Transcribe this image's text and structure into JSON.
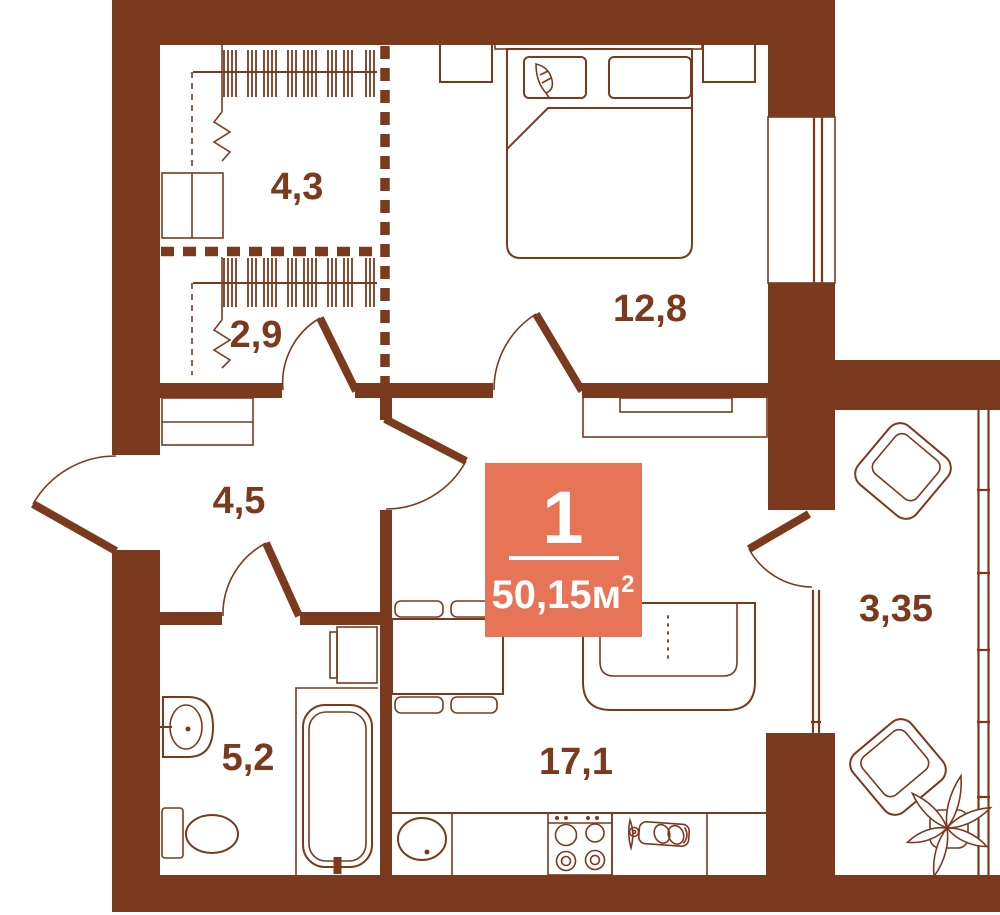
{
  "plan": {
    "kind": "apartment-floor-plan",
    "badge": {
      "room_count": "1",
      "area_value": "50,15м",
      "area_superscript": "2"
    },
    "rooms": [
      {
        "name": "wardrobe-upper",
        "area_label": "4,3"
      },
      {
        "name": "wardrobe-lower",
        "area_label": "2,9"
      },
      {
        "name": "hallway",
        "area_label": "4,5"
      },
      {
        "name": "bedroom",
        "area_label": "12,8"
      },
      {
        "name": "balcony",
        "area_label": "3,35"
      },
      {
        "name": "bathroom",
        "area_label": "5,2"
      },
      {
        "name": "kitchen-living-room",
        "area_label": "17,1"
      }
    ],
    "colors": {
      "walls_and_lines": "#7B3A1E",
      "badge_background": "#E87458",
      "badge_text": "#FFFFFF",
      "background": "#FFFFFF"
    }
  }
}
